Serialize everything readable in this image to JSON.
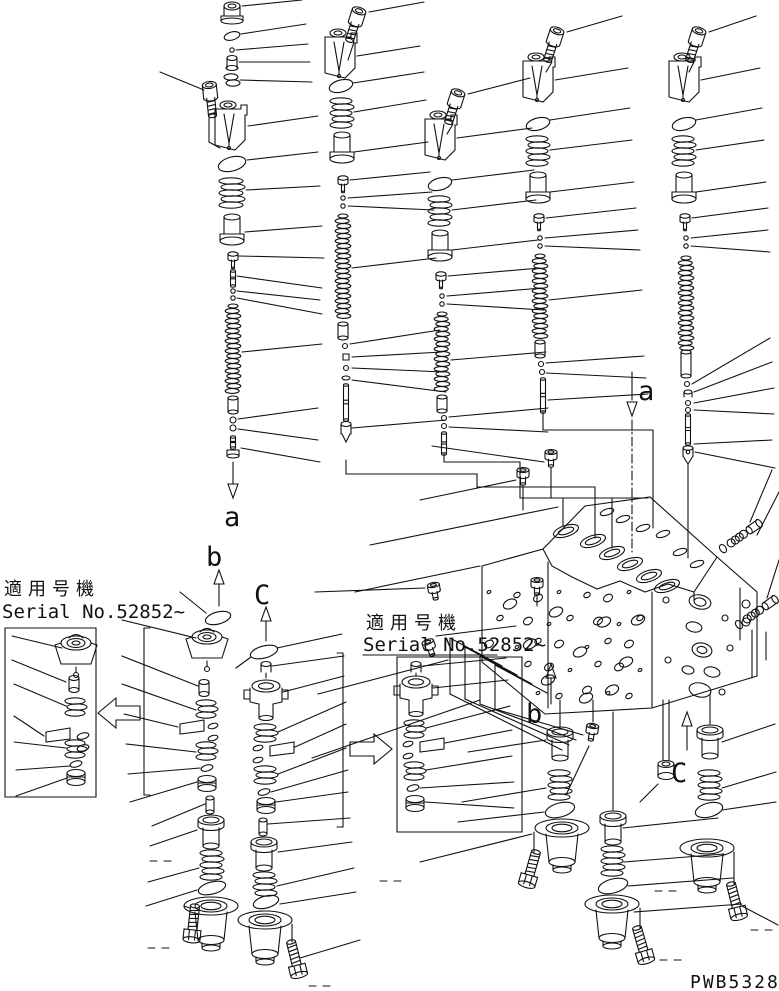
{
  "annotations": {
    "section_a": "a",
    "section_b": "b",
    "section_c": "C",
    "applicable_serial": {
      "line1": "適用号機",
      "line2": "Serial No.52852~"
    },
    "drawing_code": "PWB5328B"
  },
  "colors": {
    "ink": "#111111",
    "paper": "#ffffff"
  }
}
